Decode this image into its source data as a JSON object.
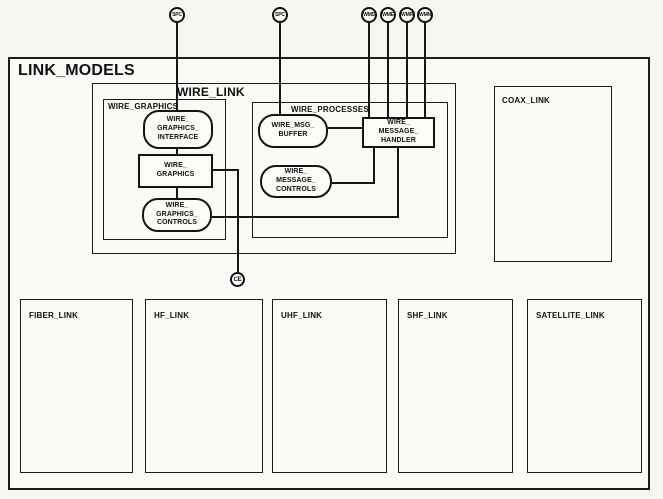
{
  "title": "LINK_MODELS",
  "containers": {
    "wire_link": "WIRE_LINK",
    "wire_graphics": "WIRE_GRAPHICS",
    "wire_processes": "WIRE_PROCESSES",
    "coax_link": "COAX_LINK",
    "fiber_link": "FIBER_LINK",
    "hf_link": "HF_LINK",
    "uhf_link": "UHF_LINK",
    "shf_link": "SHF_LINK",
    "satellite_link": "SATELLITE_LINK"
  },
  "nodes": {
    "wire_graphics_interface": "WIRE_\nGRAPHICS_\nINTERFACE",
    "wire_graphics": "WIRE_\nGRAPHICS",
    "wire_graphics_controls": "WIRE_\nGRAPHICS_\nCONTROLS",
    "wire_msg_buffer": "WIRE_MSG_\nBUFFER",
    "wire_message_handler": "WIRE_\nMESSAGE_\nHANDLER",
    "wire_message_controls": "WIRE_\nMESSAGE_\nCONTROLS"
  },
  "ports": {
    "spc1": "SPC",
    "spc2": "SPC",
    "wms": "WMS",
    "wme": "WME",
    "wmr": "WMR",
    "wmn": "WMN",
    "ce": "CE"
  },
  "colors": {
    "line": "#161616",
    "paper": "#f7f6f2"
  }
}
